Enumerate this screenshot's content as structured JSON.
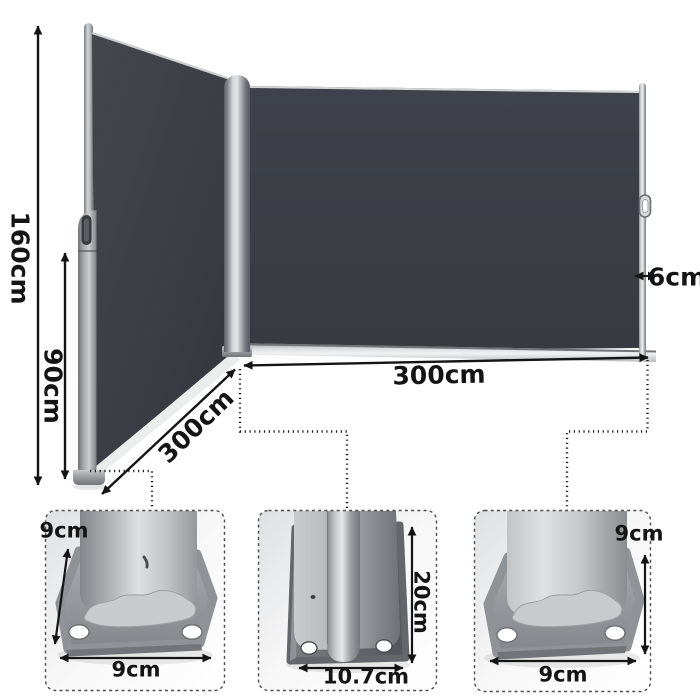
{
  "figure": {
    "kind": "product-dimension-diagram",
    "colors": {
      "background": "#ffffff",
      "fabric": "#3b3e45",
      "frame_metal": "#9b9ea2",
      "annotation_text": "#141414"
    }
  },
  "dimensions": {
    "total_height": "160cm",
    "retracted_height": "90cm",
    "left_panel_length": "300cm",
    "right_panel_length": "300cm",
    "pole_width": "6cm"
  },
  "insets": {
    "left_base": {
      "depth": "9cm",
      "width": "9cm"
    },
    "center_base": {
      "height": "20cm",
      "width": "10.7cm"
    },
    "right_base": {
      "height": "9cm",
      "width": "9cm"
    }
  }
}
